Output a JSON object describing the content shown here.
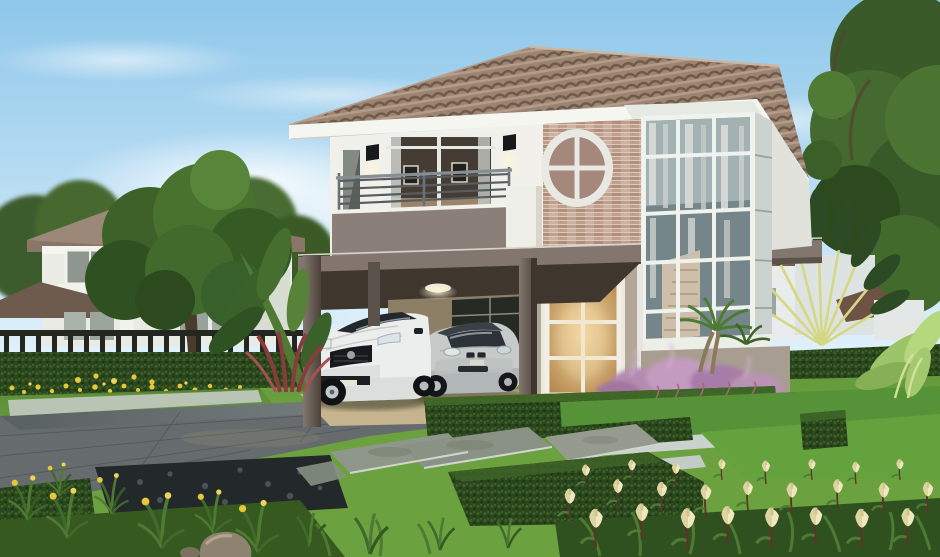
{
  "scene": {
    "type": "architectural-render",
    "description": "Photorealistic rendering of a modern two-storey suburban house with brown tiled hip roof, white upper facade with brick accent and oval window, balcony, two-storey glazed stair bay, carport sheltering a white sports car and a silver sedan, surrounded by landscaped lawns, hedges, a grey driveway, stepping stones, purple fountain grass, cream tulips and neighbouring houses among trees.",
    "palette": {
      "sky_top": "#8ec7ea",
      "sky_horizon": "#eef8fd",
      "roof": "#9b8472",
      "roof_dark": "#6f5a4a",
      "fascia": "#f6f6f1",
      "wall_white": "#f1f0ea",
      "brick": "#c8a694",
      "band_taupe": "#82766f",
      "lower_wall": "#b2a79b",
      "carport_ceiling": "#3f372e",
      "post": "#6b6059",
      "carport_floor": "#c5b48e",
      "door_glow": "#d3a569",
      "glass_dark": "#53616a",
      "lawn": "#6ba23f",
      "lawn_bright": "#63a23d",
      "hedge": "#2a461d",
      "driveway": "#666c6e",
      "paver": "#8f978b",
      "edging": "#cbd4ce",
      "wall_gray": "#97a09a",
      "purple_grass": "#b48bb0",
      "flower_cream": "#efe8be",
      "flower_yellow": "#e7c63a",
      "palm_stem": "#d6d783",
      "foliage_dark": "#2d4b22",
      "car_white": "#eceeed",
      "car_silver": "#c6cbca",
      "fence": "#23271f",
      "stone": "#8e8271"
    },
    "labels": {
      "sky": "Blue sky with wispy clouds",
      "clouds": "White clouds near horizon",
      "left_house": "Neighbouring two-storey house on the left",
      "left_tree": "Large leafy tree in front of left house",
      "fence": "Dark metal boundary fence with hedge",
      "yellow_flowers": "Strip of yellow flowers along hedge",
      "main_house": "Main two-storey house",
      "roof": "Brown tiled hip roof",
      "oval_window": "Oval feature window in brick accent wall",
      "bedroom_window": "Small upstairs window",
      "sliding_door": "Upstairs sliding glass door",
      "wall_lamps": "Black wall sconce lamps",
      "balcony": "Balcony with metal railing",
      "floor_band": "Taupe band between floors",
      "stair_bay": "Two-storey glazed stair bay with curtains",
      "front_door": "Glazed french front door with warm light",
      "carport": "Carport under the house",
      "sports_car": "White sports coupe parked in carport",
      "sedan_car": "Silver sedan parked in carport",
      "travellers_palm": "Traveller's palm fan behind garden wall",
      "right_trees": "Tall trees on the right",
      "neighbor_houses": "White neighbour houses behind palm",
      "garden_wall": "Grey garden wall with hedge on top",
      "banana_plants": "Light green banana plants",
      "lawn": "Green lawn",
      "driveway": "Grey paved driveway",
      "stepping_stones": "Stone slab path across lawn",
      "terraced_lawn": "Terraced lawn panels with concrete edging",
      "hedges": "Clipped box hedges",
      "purple_grass": "Purple fountain grass bed",
      "garden_palm": "Small garden palm by the bay window",
      "cordyline": "Red cordyline plants",
      "iris": "Yellow iris clumps in foreground",
      "cream_tulips": "Cream tulip flowers in foreground",
      "rock": "Decorative boulder on lawn",
      "gravel": "Dark pebble bed beside driveway"
    }
  }
}
